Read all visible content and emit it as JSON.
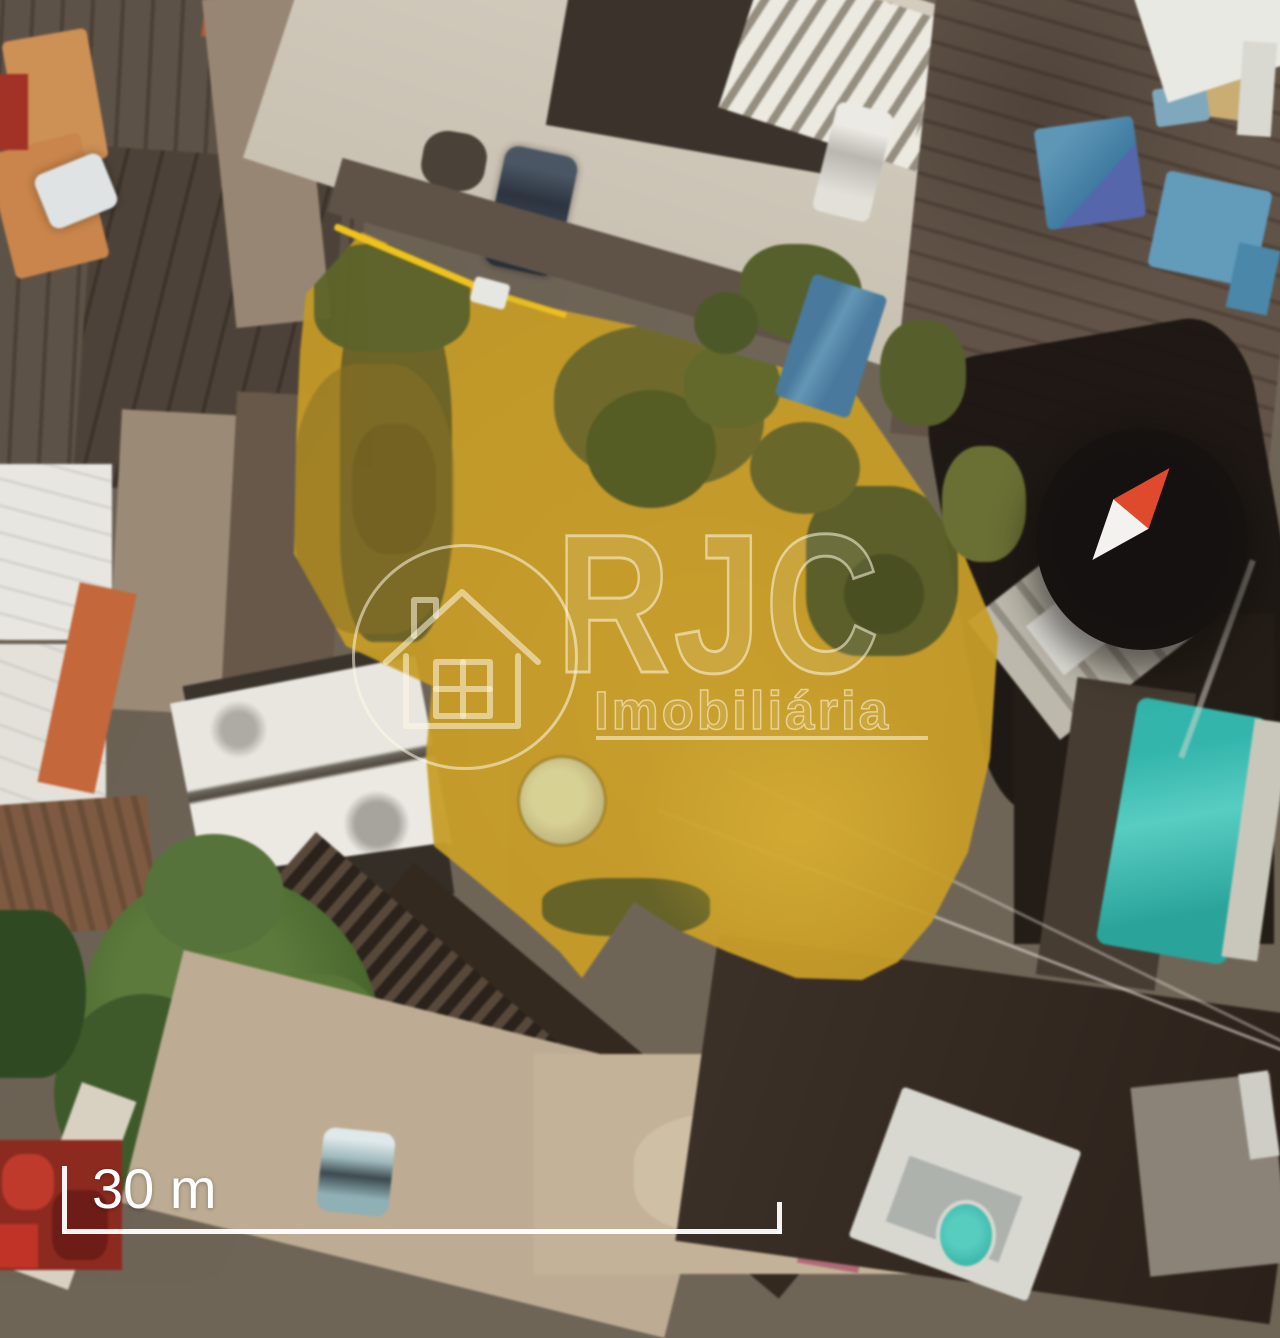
{
  "page": {
    "title": "Aerial satellite photo of a highlighted land lot"
  },
  "watermark": {
    "brand": "RJC",
    "subtitle": "Imobiliária"
  },
  "scale_bar": {
    "label": "30 m"
  },
  "icons": {
    "house": "house-outline-in-circle-icon",
    "compass": "north-arrow-needle-icon"
  },
  "colors": {
    "highlight_yellow": "#c59b27",
    "highlight_line": "#eec31d",
    "watermark_stroke": "rgba(255,248,226,0.55)",
    "watermark_fill": "rgba(255,248,226,0.10)",
    "compass_red": "#e04a2c",
    "compass_white": "#f3f2ee",
    "scale_white": "#ffffff"
  }
}
